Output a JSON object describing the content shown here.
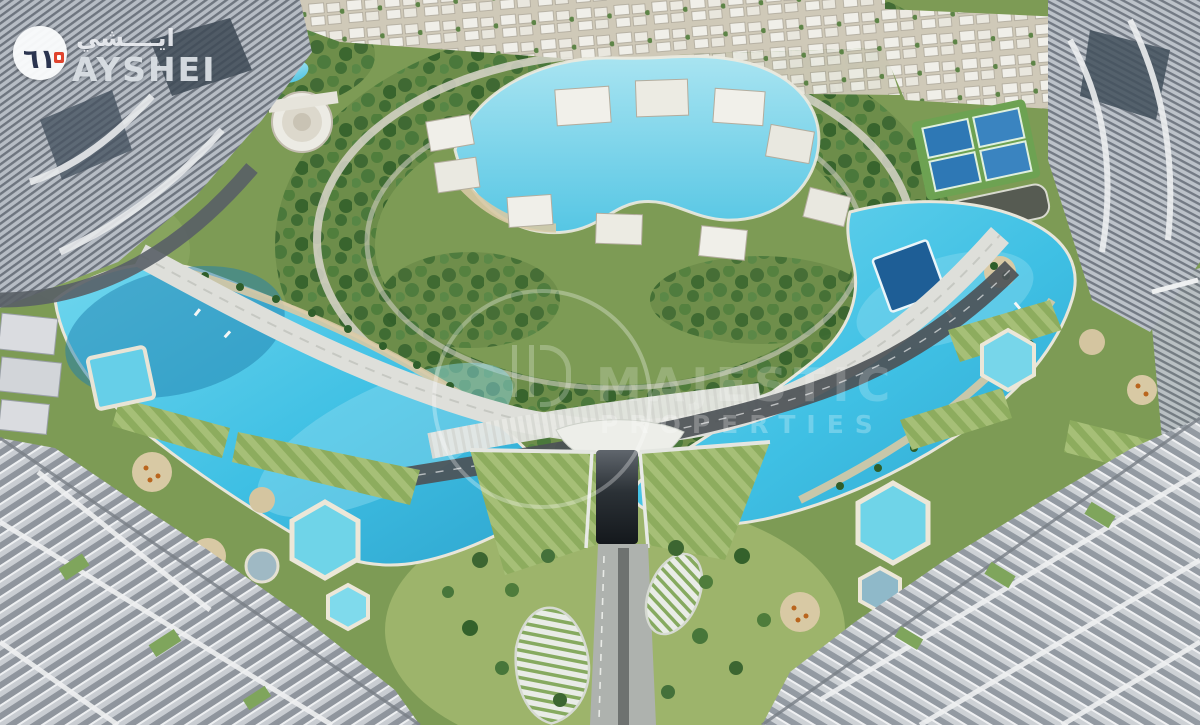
{
  "scene": {
    "description": "Aerial 3D render of a waterfront masterplan community: two crescent-shaped turquoise lagoons wrapping a central landscaped district with an upper swimmable lagoon and white villas, tennis courts at the top right, high-rise glass towers in every corner, a terraced green amphitheater with a road tunnel at bottom center, and hexagonal resort pools with sandy umbrella decks on both lower terraces."
  },
  "logo": {
    "brand": "AYSHEI",
    "brand_arabic": "ايــــشي",
    "monogram": "٦١",
    "mark_icon": "ayshei-monogram-icon"
  },
  "watermark": {
    "line1": "MAJESTIC",
    "line2": "PROPERTIES",
    "mark_icon": "ring-logo-icon"
  },
  "palette": {
    "lagoon": "#3fc0e4",
    "lagoon_deep": "#1f7fae",
    "lagoon_light": "#8fdcef",
    "green_base": "#7d9b55",
    "green_tree": "#3f6a33",
    "lawn": "#a3bd74",
    "sand": "#d8c9a4",
    "road_light": "#dedfda",
    "road_dark": "#4d5257",
    "tower_light": "#d2d5d9",
    "tower_mid": "#8e939a",
    "navy": "#2b3550",
    "accent_red": "#e0442e"
  }
}
